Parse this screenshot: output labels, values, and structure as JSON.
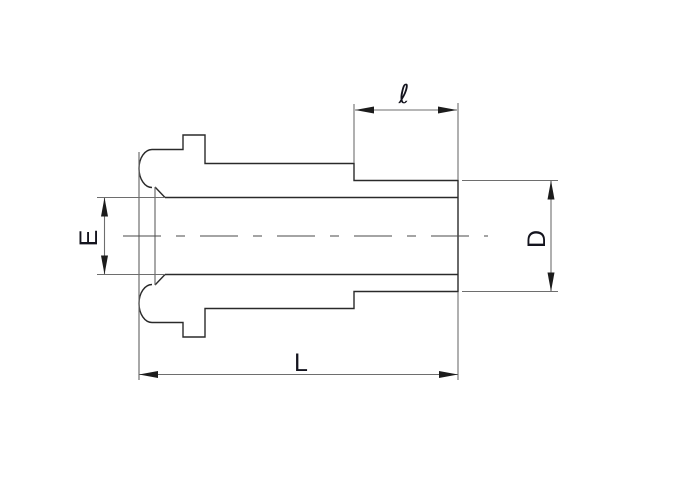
{
  "figure": {
    "type": "engineering-drawing",
    "subject": "side-profile technical drawing of a tube butt-weld gland fitting with sealing bead nose",
    "colors": {
      "background": "#ffffff",
      "profile_line": "#2a2a2a",
      "dimension_line": "#6e6e6e",
      "centerline": "#4a4a4a",
      "arrow": "#1c1c1c",
      "label_text": "#14141e"
    },
    "dim_labels": {
      "ell": "ℓ",
      "E": "E",
      "D": "D",
      "L": "L"
    }
  }
}
